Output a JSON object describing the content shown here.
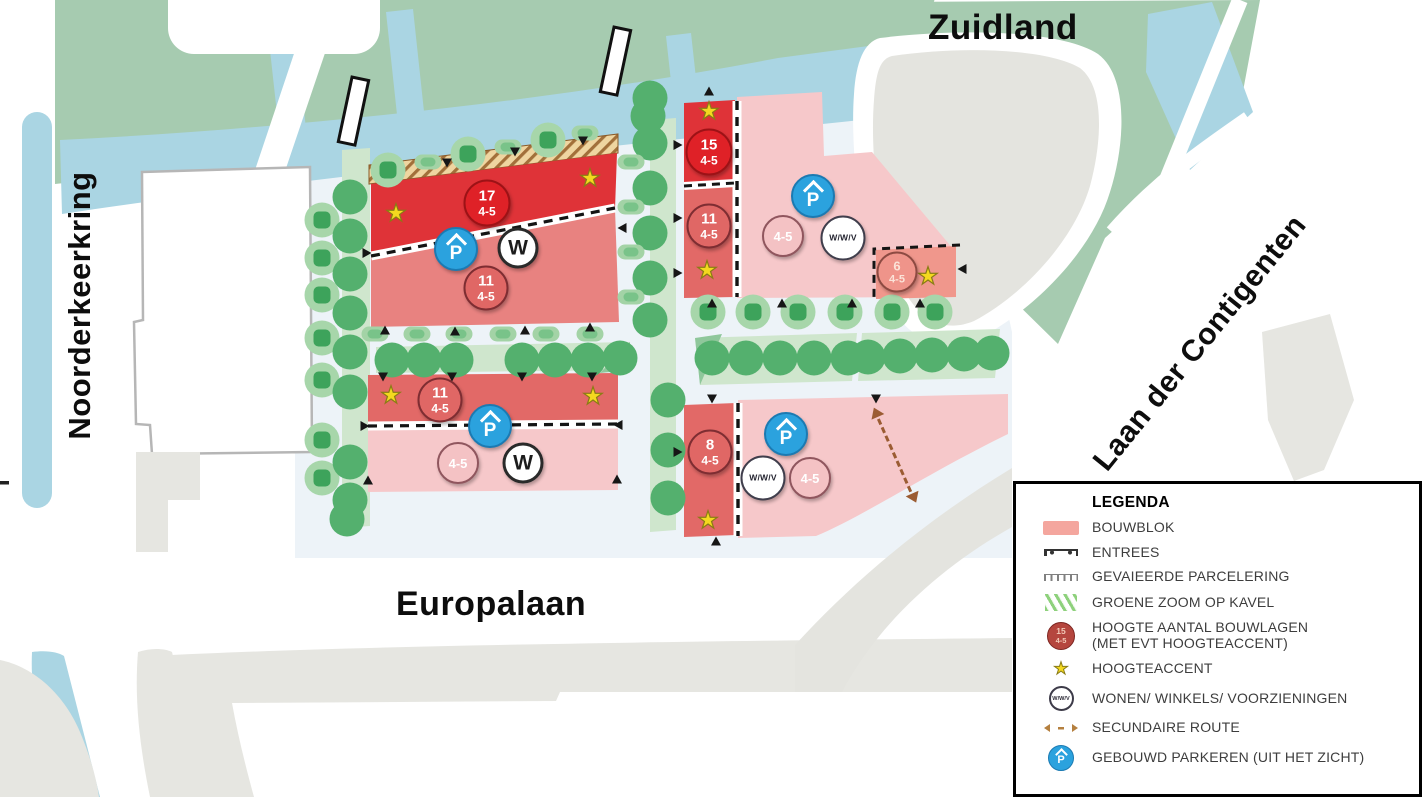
{
  "streets": {
    "top": "Zuidland",
    "left": "Noorderkeerkring",
    "bottom": "Europalaan",
    "right": "Laan der Contigenten"
  },
  "colors": {
    "park_green": "#a6cbb0",
    "water_blue": "#aad5e3",
    "plaza": "#edf3f8",
    "block_dark_red": "#df3338",
    "block_medium_red": "#e26967",
    "block_salmon": "#e88280",
    "block_light_pink": "#f6c8ca",
    "block_soft_salmon": "#f0978c",
    "tree_green": "#54b06e",
    "accent_yellow": "#f4d81f",
    "parking_blue": "#2ba2de",
    "building_grey": "#e6e6e1",
    "route_brown": "#9b5c33"
  },
  "legend": {
    "title": "LEGENDA",
    "items": [
      {
        "symbol": "bouwblok",
        "label": "BOUWBLOK"
      },
      {
        "symbol": "entrees",
        "label": "ENTREES"
      },
      {
        "symbol": "parcelering",
        "label": "GEVAIEERDE PARCELERING"
      },
      {
        "symbol": "groene-zoom",
        "label": "GROENE ZOOM OP KAVEL"
      },
      {
        "symbol": "hoogte",
        "label": "HOOGTE AANTAL BOUWLAGEN\n(MET EVT HOOGTEACCENT)",
        "badge_lines": [
          "15",
          "4-5"
        ]
      },
      {
        "symbol": "ster",
        "label": "HOOGTEACCENT"
      },
      {
        "symbol": "wwv",
        "label": "WONEN/ WINKELS/ VOORZIENINGEN",
        "text": "W/W/V"
      },
      {
        "symbol": "route",
        "label": "SECUNDAIRE ROUTE"
      },
      {
        "symbol": "parkeren",
        "label": "GEBOUWD PARKEREN (UIT HET ZICHT)",
        "text": "P"
      }
    ]
  },
  "map": {
    "star_glyph": "★",
    "badges": [
      {
        "type": "level-high",
        "x": 487,
        "y": 203,
        "lines": [
          "17",
          "4-5"
        ]
      },
      {
        "type": "level-high",
        "x": 709,
        "y": 152,
        "lines": [
          "15",
          "4-5"
        ]
      },
      {
        "type": "level-med",
        "x": 486,
        "y": 288,
        "lines": [
          "11",
          "4-5"
        ]
      },
      {
        "type": "level-med",
        "x": 440,
        "y": 400,
        "lines": [
          "11",
          "4-5"
        ]
      },
      {
        "type": "level-med",
        "x": 709,
        "y": 226,
        "lines": [
          "11",
          "4-5"
        ]
      },
      {
        "type": "level-med",
        "x": 710,
        "y": 452,
        "lines": [
          "8",
          "4-5"
        ]
      },
      {
        "type": "level-soft",
        "x": 897,
        "y": 272,
        "lines": [
          "6",
          "4-5"
        ]
      },
      {
        "type": "level-light",
        "x": 783,
        "y": 236,
        "lines": [
          "4-5"
        ]
      },
      {
        "type": "level-light",
        "x": 458,
        "y": 463,
        "lines": [
          "4-5"
        ]
      },
      {
        "type": "level-light",
        "x": 810,
        "y": 478,
        "lines": [
          "4-5"
        ]
      },
      {
        "type": "parking",
        "x": 456,
        "y": 249,
        "lines": [
          "P"
        ]
      },
      {
        "type": "parking",
        "x": 490,
        "y": 426,
        "lines": [
          "P"
        ]
      },
      {
        "type": "parking",
        "x": 813,
        "y": 196,
        "lines": [
          "P"
        ]
      },
      {
        "type": "parking",
        "x": 786,
        "y": 434,
        "lines": [
          "P"
        ]
      },
      {
        "type": "wonen",
        "x": 518,
        "y": 248,
        "lines": [
          "W"
        ]
      },
      {
        "type": "wonen",
        "x": 523,
        "y": 463,
        "lines": [
          "W"
        ]
      },
      {
        "type": "mixed",
        "x": 843,
        "y": 238,
        "lines": [
          "W/W/V"
        ]
      },
      {
        "type": "mixed",
        "x": 763,
        "y": 478,
        "lines": [
          "W/W/V"
        ]
      }
    ],
    "stars": [
      [
        396,
        214
      ],
      [
        590,
        179
      ],
      [
        391,
        396
      ],
      [
        593,
        397
      ],
      [
        709,
        112
      ],
      [
        707,
        271
      ],
      [
        928,
        277
      ],
      [
        708,
        521
      ]
    ],
    "entrance_markers": [
      [
        447,
        163,
        180
      ],
      [
        515,
        152,
        180
      ],
      [
        583,
        141,
        180
      ],
      [
        385,
        330,
        0
      ],
      [
        455,
        331,
        0
      ],
      [
        525,
        330,
        0
      ],
      [
        590,
        327,
        0
      ],
      [
        367,
        253,
        90
      ],
      [
        622,
        228,
        270
      ],
      [
        383,
        377,
        180
      ],
      [
        452,
        377,
        180
      ],
      [
        522,
        377,
        180
      ],
      [
        592,
        377,
        180
      ],
      [
        365,
        426,
        90
      ],
      [
        618,
        425,
        270
      ],
      [
        368,
        480,
        0
      ],
      [
        617,
        479,
        0
      ],
      [
        678,
        145,
        90
      ],
      [
        678,
        218,
        90
      ],
      [
        678,
        273,
        90
      ],
      [
        709,
        91,
        0
      ],
      [
        712,
        303,
        0
      ],
      [
        782,
        303,
        0
      ],
      [
        852,
        303,
        0
      ],
      [
        920,
        303,
        0
      ],
      [
        962,
        269,
        270
      ],
      [
        712,
        399,
        180
      ],
      [
        876,
        399,
        180
      ],
      [
        678,
        452,
        90
      ],
      [
        716,
        541,
        0
      ]
    ],
    "trees": [
      [
        "t1",
        388,
        170
      ],
      [
        "t1",
        468,
        154
      ],
      [
        "t1",
        548,
        140
      ],
      [
        "bush",
        428,
        162
      ],
      [
        "bush",
        508,
        147
      ],
      [
        "bush",
        585,
        133
      ],
      [
        "t2",
        648,
        116
      ],
      [
        "t1",
        322,
        220
      ],
      [
        "t1",
        322,
        258
      ],
      [
        "t1",
        322,
        295
      ],
      [
        "t1",
        322,
        338
      ],
      [
        "t1",
        322,
        380
      ],
      [
        "t1",
        322,
        440
      ],
      [
        "t1",
        322,
        478
      ],
      [
        "t2",
        350,
        197
      ],
      [
        "t2",
        350,
        236
      ],
      [
        "t2",
        350,
        274
      ],
      [
        "t2",
        350,
        313
      ],
      [
        "t2",
        350,
        352
      ],
      [
        "t2",
        350,
        392
      ],
      [
        "t2",
        350,
        462
      ],
      [
        "t2",
        350,
        500
      ],
      [
        "t2",
        347,
        519
      ],
      [
        "t2",
        650,
        98
      ],
      [
        "t2",
        650,
        143
      ],
      [
        "t2",
        650,
        188
      ],
      [
        "t2",
        650,
        233
      ],
      [
        "t2",
        650,
        278
      ],
      [
        "t2",
        650,
        320
      ],
      [
        "bush",
        631,
        162
      ],
      [
        "bush",
        631,
        207
      ],
      [
        "bush",
        631,
        252
      ],
      [
        "bush",
        631,
        297
      ],
      [
        "t2",
        668,
        400
      ],
      [
        "t2",
        668,
        450
      ],
      [
        "t2",
        668,
        498
      ],
      [
        "bush",
        375,
        334
      ],
      [
        "bush",
        417,
        334
      ],
      [
        "bush",
        459,
        334
      ],
      [
        "bush",
        503,
        334
      ],
      [
        "bush",
        546,
        334
      ],
      [
        "bush",
        590,
        334
      ],
      [
        "t2",
        392,
        360
      ],
      [
        "t2",
        424,
        360
      ],
      [
        "t2",
        456,
        360
      ],
      [
        "t2",
        522,
        360
      ],
      [
        "t2",
        555,
        360
      ],
      [
        "t2",
        588,
        360
      ],
      [
        "t2",
        620,
        358
      ],
      [
        "t1",
        708,
        312
      ],
      [
        "t1",
        753,
        312
      ],
      [
        "t1",
        798,
        312
      ],
      [
        "t1",
        845,
        312
      ],
      [
        "t1",
        892,
        312
      ],
      [
        "t1",
        935,
        312
      ],
      [
        "t2",
        712,
        358
      ],
      [
        "t2",
        746,
        358
      ],
      [
        "t2",
        780,
        358
      ],
      [
        "t2",
        814,
        358
      ],
      [
        "t2",
        848,
        358
      ],
      [
        "t2",
        868,
        357
      ],
      [
        "t2",
        900,
        356
      ],
      [
        "t2",
        932,
        355
      ],
      [
        "t2",
        964,
        354
      ],
      [
        "t2",
        992,
        353
      ]
    ]
  }
}
